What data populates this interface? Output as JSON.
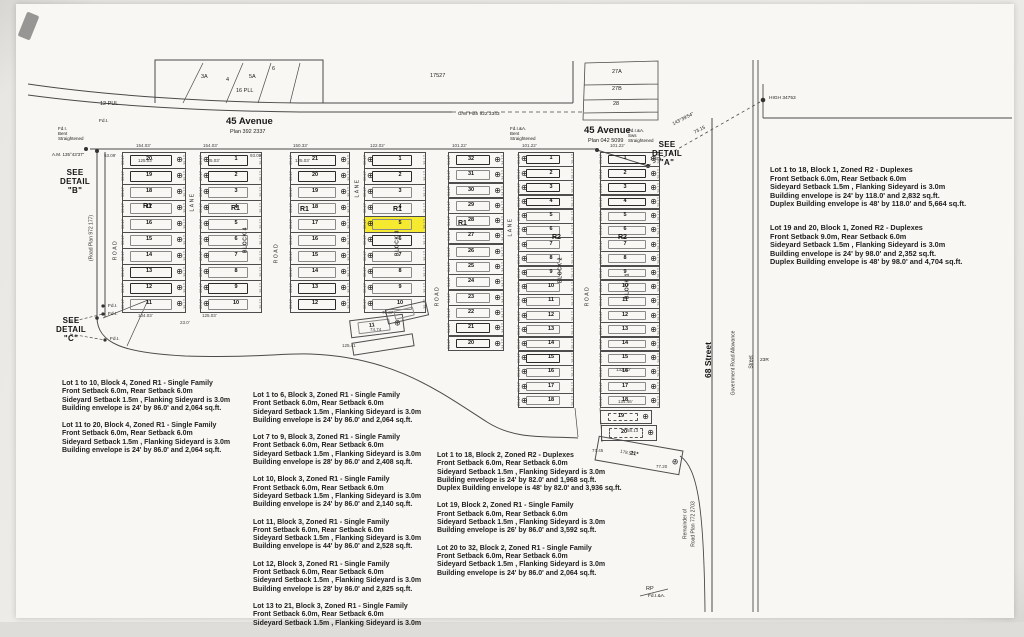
{
  "scene": {
    "highlight_color": "#f5ea2f",
    "ink_color": "#4a4a4a",
    "page_color": "#f9f7f3"
  },
  "columns": [
    {
      "name": "block4-west",
      "x": 122,
      "top": 152,
      "w": 64,
      "lotH": 16,
      "circle": "right",
      "edge": "35.17",
      "lots": [
        "20",
        "19",
        "18",
        "17",
        "16",
        "15",
        "14",
        "13",
        "12",
        "11"
      ],
      "bold": [
        0,
        1,
        7,
        8
      ]
    },
    {
      "name": "block4-east",
      "x": 200,
      "top": 152,
      "w": 62,
      "lotH": 16,
      "circle": "left",
      "edge": "35.17",
      "lots": [
        "1",
        "2",
        "3",
        "4",
        "5",
        "6",
        "7",
        "8",
        "9",
        "10"
      ],
      "bold": [
        0,
        1,
        8
      ]
    },
    {
      "name": "block3-west",
      "x": 290,
      "top": 152,
      "w": 60,
      "lotH": 16,
      "circle": "right",
      "edge": "35.17",
      "lots": [
        "21",
        "20",
        "19",
        "18",
        "17",
        "16",
        "15",
        "14",
        "13",
        "12"
      ],
      "bold": [
        0,
        1,
        8,
        9
      ]
    },
    {
      "name": "block3-east",
      "x": 364,
      "top": 152,
      "w": 62,
      "lotH": 16,
      "circle": "left",
      "edge": "35.17",
      "lots": [
        "1",
        "2",
        "3",
        "4",
        "5",
        "6",
        "7",
        "8",
        "9",
        "10"
      ],
      "bold": [
        0,
        1,
        5
      ],
      "highlight": "5"
    },
    {
      "name": "block2-west",
      "x": 448,
      "top": 152,
      "w": 56,
      "lotH": 15.3,
      "circle": "right",
      "edge": "34.17",
      "lots": [
        "32",
        "31",
        "30",
        "29",
        "28",
        "27",
        "26",
        "25",
        "24",
        "23",
        "22",
        "21",
        "20"
      ],
      "bold": [
        0,
        11,
        12
      ]
    },
    {
      "name": "block2-east",
      "x": 518,
      "top": 152,
      "w": 56,
      "lotH": 14.2,
      "circle": "left",
      "edge": "25.17",
      "lots": [
        "1",
        "2",
        "3",
        "4",
        "5",
        "6",
        "7",
        "8",
        "9",
        "10",
        "11",
        "12",
        "13",
        "14",
        "15",
        "16",
        "17",
        "18"
      ],
      "bold": [
        0,
        1,
        2,
        3,
        14
      ]
    },
    {
      "name": "block1",
      "x": 600,
      "top": 152,
      "w": 60,
      "lotH": 14.2,
      "circle": "right",
      "edge": "25.17",
      "lots": [
        "1",
        "2",
        "3",
        "4",
        "5",
        "6",
        "7",
        "8",
        "9",
        "10",
        "11",
        "12",
        "13",
        "14",
        "15",
        "16",
        "17",
        "18"
      ],
      "bold": [
        0,
        1,
        2,
        3
      ]
    }
  ],
  "extra_lots": [
    {
      "label": "19",
      "name": "block1-lot-19",
      "x": 600,
      "y": 410,
      "w": 52,
      "h": 14,
      "circle": "right",
      "env": "dash"
    },
    {
      "label": "20",
      "name": "block1-lot-20",
      "x": 601,
      "y": 425,
      "w": 56,
      "h": 16,
      "circle": "right",
      "env": "dash"
    },
    {
      "label": "21*",
      "name": "block1-lot-21",
      "x": 596,
      "y": 443,
      "w": 86,
      "h": 25,
      "rot": 10,
      "circle": "right",
      "env": "none"
    },
    {
      "label": "11",
      "name": "block3-lot-11",
      "x": 350,
      "y": 317,
      "w": 54,
      "h": 18,
      "rot": -7,
      "circle": "right",
      "env": "plain"
    },
    {
      "label": "",
      "name": "block3-parcel",
      "x": 386,
      "y": 305,
      "w": 42,
      "h": 15,
      "rot": -13,
      "env": "plain"
    },
    {
      "label": "",
      "name": "block3-parcel",
      "x": 352,
      "y": 338,
      "w": 62,
      "h": 13,
      "rot": -9,
      "env": "none"
    }
  ],
  "labels": [
    {
      "t": "12 PUL",
      "x": 100,
      "y": 101,
      "cls": "t5",
      "n": "label-12-pul"
    },
    {
      "t": "16 PLL",
      "x": 236,
      "y": 88,
      "cls": "t5",
      "n": "label-16-pll"
    },
    {
      "t": "17527",
      "x": 430,
      "y": 73,
      "cls": "t5",
      "n": "label-17527"
    },
    {
      "t": "U/W Plan 922 3343",
      "x": 458,
      "y": 112,
      "cls": "t45",
      "n": "label-uw-plan"
    },
    {
      "t": "3A",
      "x": 201,
      "y": 74,
      "cls": "t5",
      "n": "lot-label-3a"
    },
    {
      "t": "4",
      "x": 226,
      "y": 77,
      "cls": "t5",
      "n": "lot-label-4"
    },
    {
      "t": "5A",
      "x": 249,
      "y": 74,
      "cls": "t5",
      "n": "lot-label-5a"
    },
    {
      "t": "6",
      "x": 272,
      "y": 66,
      "cls": "t5",
      "n": "lot-label-6"
    },
    {
      "t": "27A",
      "x": 612,
      "y": 69,
      "cls": "t5",
      "n": "lot-label-27a"
    },
    {
      "t": "27B",
      "x": 612,
      "y": 86,
      "cls": "t5",
      "n": "lot-label-27b"
    },
    {
      "t": "28",
      "x": 613,
      "y": 101,
      "cls": "t5",
      "n": "lot-label-28"
    },
    {
      "t": "45 Avenue",
      "x": 226,
      "y": 117,
      "cls": "street",
      "n": "street-45-avenue-west"
    },
    {
      "t": "Plan 392 2337",
      "x": 230,
      "y": 129,
      "cls": "t5",
      "n": "plan-number-west"
    },
    {
      "t": "45 Avenue",
      "x": 584,
      "y": 126,
      "cls": "street",
      "n": "street-45-avenue-east"
    },
    {
      "t": "Plan 042 5099",
      "x": 588,
      "y": 138,
      "cls": "t5",
      "n": "plan-number-east"
    },
    {
      "lines": [
        "SEE",
        "DETAIL",
        "\"A\""
      ],
      "x": 652,
      "y": 140,
      "cls": "see",
      "n": "see-detail-a"
    },
    {
      "lines": [
        "SEE",
        "DETAIL",
        "\"B\""
      ],
      "x": 60,
      "y": 168,
      "cls": "see",
      "n": "see-detail-b"
    },
    {
      "lines": [
        "SEE",
        "DETAIL",
        "\"C\""
      ],
      "x": 56,
      "y": 316,
      "cls": "see",
      "n": "see-detail-c"
    },
    {
      "t": "143°39'54\"",
      "x": 672,
      "y": 117,
      "cls": "t45",
      "rot": -27,
      "n": "bearing-label"
    },
    {
      "t": "73.15",
      "x": 694,
      "y": 128,
      "cls": "t45",
      "rot": -27,
      "n": "distance-label"
    },
    {
      "t": "HIGH 34753",
      "x": 769,
      "y": 96,
      "cls": "t45",
      "n": "monument-label"
    },
    {
      "lines": [
        "Fd.I.",
        "Bent",
        "Straightened"
      ],
      "x": 58,
      "y": 126,
      "cls": "t4",
      "n": "survey-note"
    },
    {
      "t": "Fd.I.",
      "x": 99,
      "y": 119,
      "cls": "t45",
      "n": "survey-note"
    },
    {
      "t": "A.M. 135°43'37\"",
      "x": 52,
      "y": 152,
      "cls": "t4",
      "n": "survey-note"
    },
    {
      "lines": [
        "Fd.I.&A.",
        "Bent",
        "Straightened"
      ],
      "x": 510,
      "y": 126,
      "cls": "t4",
      "n": "survey-note"
    },
    {
      "lines": [
        "Fd.I.&A.",
        "Sws",
        "Straightened"
      ],
      "x": 628,
      "y": 128,
      "cls": "t4",
      "n": "survey-note"
    },
    {
      "t": "Fd.I.",
      "x": 108,
      "y": 304,
      "cls": "t45",
      "n": "survey-note"
    },
    {
      "t": "Fd.I.",
      "x": 108,
      "y": 312,
      "cls": "t45",
      "n": "survey-note"
    },
    {
      "t": "Fd.I.",
      "x": 110,
      "y": 337,
      "cls": "t45",
      "n": "survey-note"
    },
    {
      "t": "RP",
      "x": 646,
      "y": 586,
      "cls": "t5",
      "n": "survey-note"
    },
    {
      "t": "Fd.I.&A.",
      "x": 648,
      "y": 594,
      "cls": "t45",
      "n": "survey-note"
    },
    {
      "t": "23R",
      "x": 760,
      "y": 358,
      "cls": "t45",
      "n": "parcel-label-23r"
    },
    {
      "t": "ROAD",
      "x": 116,
      "y": 250,
      "cls": "vroad",
      "n": "road-label"
    },
    {
      "t": "LANE",
      "x": 193,
      "y": 202,
      "cls": "vroad",
      "n": "lane-label"
    },
    {
      "t": "ROAD",
      "x": 277,
      "y": 253,
      "cls": "vroad",
      "n": "road-label"
    },
    {
      "t": "LANE",
      "x": 358,
      "y": 188,
      "cls": "vroad",
      "n": "lane-label"
    },
    {
      "t": "ROAD",
      "x": 438,
      "y": 296,
      "cls": "vroad",
      "n": "road-label"
    },
    {
      "t": "LANE",
      "x": 511,
      "y": 227,
      "cls": "vroad",
      "n": "lane-label"
    },
    {
      "t": "ROAD",
      "x": 588,
      "y": 296,
      "cls": "vroad",
      "n": "road-label"
    },
    {
      "t": "BLOCK 4",
      "x": 246,
      "y": 240,
      "cls": "vblock",
      "n": "block-4-label"
    },
    {
      "t": "BLOCK 3",
      "x": 398,
      "y": 243,
      "cls": "vblock",
      "n": "block-3-label"
    },
    {
      "t": "BLOCK 2",
      "x": 561,
      "y": 270,
      "cls": "vblock",
      "n": "block-2-label"
    },
    {
      "t": "BLOCK 1",
      "x": 628,
      "y": 286,
      "cls": "vblock",
      "n": "block-1-label"
    },
    {
      "t": "68 Street",
      "x": 708,
      "y": 360,
      "cls": "vstreet",
      "n": "street-68"
    },
    {
      "t": "Government Road Allowance",
      "x": 734,
      "y": 363,
      "cls": "vtiny",
      "n": "gov-road-allowance-label"
    },
    {
      "t": "Street",
      "x": 752,
      "y": 362,
      "cls": "vtiny",
      "n": "street-label-small"
    },
    {
      "t": "Remainder of",
      "x": 686,
      "y": 524,
      "cls": "vtiny",
      "n": "remainder-label"
    },
    {
      "t": "Road Plan 772 2703",
      "x": 694,
      "y": 524,
      "cls": "vtiny",
      "n": "remainder-plan-label"
    },
    {
      "t": "(Road Plan 972 177)",
      "x": 92,
      "y": 238,
      "cls": "vtiny",
      "n": "road-plan-left-label"
    },
    {
      "t": "R1",
      "x": 143,
      "y": 203,
      "cls": "zone",
      "n": "zone-r1"
    },
    {
      "t": "R1",
      "x": 231,
      "y": 205,
      "cls": "zone",
      "n": "zone-r1"
    },
    {
      "t": "R1",
      "x": 300,
      "y": 206,
      "cls": "zone",
      "n": "zone-r1"
    },
    {
      "t": "R1",
      "x": 393,
      "y": 206,
      "cls": "zone",
      "n": "zone-r1"
    },
    {
      "t": "R1",
      "x": 458,
      "y": 220,
      "cls": "zone",
      "n": "zone-r1"
    },
    {
      "t": "R2",
      "x": 552,
      "y": 234,
      "cls": "zone",
      "n": "zone-r2"
    },
    {
      "t": "R2",
      "x": 618,
      "y": 234,
      "cls": "zone",
      "n": "zone-r2"
    }
  ],
  "dims": [
    {
      "t": "53.09'",
      "x": 104,
      "y": 154
    },
    {
      "t": "154.03'",
      "x": 136,
      "y": 144
    },
    {
      "t": "125.03'",
      "x": 138,
      "y": 159
    },
    {
      "t": "154.03'",
      "x": 203,
      "y": 144
    },
    {
      "t": "125.03'",
      "x": 205,
      "y": 159
    },
    {
      "t": "93.09'",
      "x": 250,
      "y": 154
    },
    {
      "t": "150.33'",
      "x": 293,
      "y": 144
    },
    {
      "t": "125.03'",
      "x": 295,
      "y": 159
    },
    {
      "t": "122.02'",
      "x": 370,
      "y": 144
    },
    {
      "t": "101.22'",
      "x": 452,
      "y": 144
    },
    {
      "t": "101.22'",
      "x": 522,
      "y": 144
    },
    {
      "t": "101.22'",
      "x": 610,
      "y": 144
    },
    {
      "t": "14.21",
      "x": 650,
      "y": 157
    },
    {
      "t": "104.03'",
      "x": 138,
      "y": 314
    },
    {
      "t": "125.03'",
      "x": 202,
      "y": 314
    },
    {
      "t": "23.0'",
      "x": 180,
      "y": 321
    },
    {
      "t": "79.37",
      "x": 382,
      "y": 311
    },
    {
      "t": "74.74",
      "x": 370,
      "y": 328
    },
    {
      "t": "125.41",
      "x": 342,
      "y": 344
    },
    {
      "t": "132.30'",
      "x": 616,
      "y": 368
    },
    {
      "t": "134.46'",
      "x": 618,
      "y": 400
    },
    {
      "t": "58.13",
      "x": 627,
      "y": 429
    },
    {
      "t": "178.57",
      "x": 620,
      "y": 451,
      "rot": 12
    },
    {
      "t": "77.45",
      "x": 592,
      "y": 449
    },
    {
      "t": "77.20",
      "x": 656,
      "y": 465
    }
  ],
  "notes_groups": [
    {
      "x": 62,
      "y": 380,
      "big": false,
      "paras": [
        [
          "Lot 1 to 10, Block 4, Zoned R1 - Single Family",
          "Front Setback 6.0m, Rear Setback 6.0m",
          "Sideyard Setback 1.5m , Flanking Sideyard is 3.0m",
          "Building envelope is 24' by 86.0' and 2,064 sq.ft."
        ],
        [
          "Lot 11 to 20, Block 4, Zoned R1 - Single Family",
          "Front Setback 6.0m, Rear Setback 6.0m",
          "Sideyard Setback 1.5m , Flanking Sideyard is 3.0m",
          "Building envelope is 24' by 86.0' and 2,064 sq.ft."
        ]
      ]
    },
    {
      "x": 253,
      "y": 392,
      "big": false,
      "paras": [
        [
          "Lot 1 to 6, Block 3, Zoned R1 - Single Family",
          "Front Setback 6.0m, Rear Setback 6.0m",
          "Sideyard Setback 1.5m , Flanking Sideyard is 3.0m",
          "Building envelope is 24' by 86.0' and 2,064 sq.ft."
        ],
        [
          "Lot 7 to 9, Block 3, Zoned R1 - Single Family",
          "Front Setback 6.0m, Rear Setback 6.0m",
          "Sideyard Setback 1.5m , Flanking Sideyard is 3.0m",
          "Building envelope is 28' by 86.0' and 2,408 sq.ft."
        ],
        [
          "Lot 10, Block 3, Zoned R1 - Single Family",
          "Front Setback 6.0m, Rear Setback 6.0m",
          "Sideyard Setback 1.5m , Flanking Sideyard is 3.0m",
          "Building envelope is 24' by 86.0' and 2,140 sq.ft."
        ],
        [
          "Lot 11, Block 3, Zoned R1 - Single Family",
          "Front Setback 6.0m, Rear Setback 6.0m",
          "Sideyard Setback 1.5m , Flanking Sideyard is 3.0m",
          "Building envelope is 44' by 86.0' and 2,528 sq.ft."
        ],
        [
          "Lot 12, Block 3, Zoned R1 - Single Family",
          "Front Setback 6.0m, Rear Setback 6.0m",
          "Sideyard Setback 1.5m , Flanking Sideyard is 3.0m",
          "Building envelope is 28' by 86.0' and 2,825 sq.ft."
        ],
        [
          "Lot 13 to 21, Block 3, Zoned R1 - Single Family",
          "Front Setback 6.0m, Rear Setback 6.0m",
          "Sideyard Setback 1.5m , Flanking Sideyard is 3.0m"
        ]
      ]
    },
    {
      "x": 437,
      "y": 452,
      "big": false,
      "paras": [
        [
          "Lot 1 to 18, Block 2, Zoned R2 - Duplexes",
          "Front Setback 6.0m, Rear Setback 6.0m",
          "Sideyard Setback 1.5m , Flanking Sideyard is 3.0m",
          "Building envelope is 24' by 82.0' and 1,968 sq.ft.",
          "Duplex Building envelope is 48' by 82.0' and 3,936 sq.ft."
        ],
        [
          "Lot 19, Block 2, Zoned R1 - Single Family",
          "Front Setback 6.0m, Rear Setback 6.0m",
          "Sideyard Setback 1.5m , Flanking Sideyard is 3.0m",
          "Building envelope is 26' by 86.0' and 3,592 sq.ft."
        ],
        [
          "Lot 20 to 32, Block 2, Zoned R1 - Single Family",
          "Front Setback 6.0m, Rear Setback 6.0m",
          "Sideyard Setback 1.5m , Flanking Sideyard is 3.0m",
          "Building envelope is 24' by 86.0' and 2,064 sq.ft."
        ]
      ]
    },
    {
      "x": 770,
      "y": 166,
      "big": true,
      "paras": [
        [
          "Lot 1 to 18, Block 1, Zoned R2 - Duplexes",
          "Front Setback 6.0m, Rear Setback 6.0m",
          "Sideyard Setback 1.5m , Flanking Sideyard is 3.0m",
          "Building envelope is 24' by 118.0' and 2,832 sq.ft.",
          "Duplex Building envelope is 48' by 118.0' and 5,664 sq.ft."
        ],
        [
          "Lot 19 and 20, Block 1, Zoned R2 - Duplexes",
          "Front Setback 9.0m, Rear Setback 6.0m",
          "Sideyard Setback 1.5m , Flanking Sideyard is 3.0m",
          "Building envelope is 24' by 98.0' and 2,352 sq.ft.",
          "Duplex Building envelope is 48' by 98.0' and 4,704 sq.ft."
        ]
      ]
    }
  ],
  "monument_icon": "⊕"
}
